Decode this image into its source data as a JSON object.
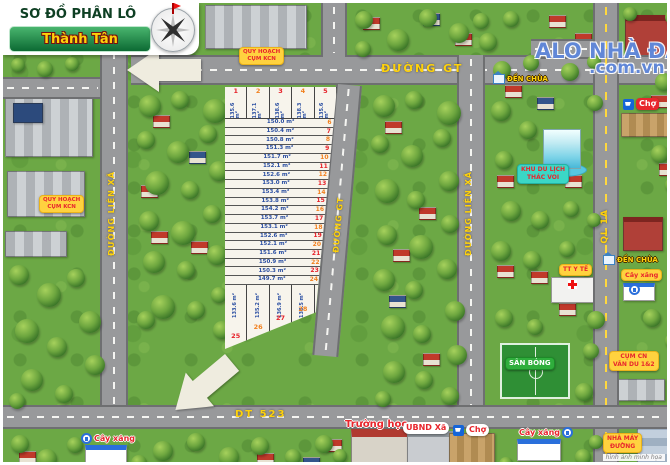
{
  "title": {
    "line1": "SƠ ĐỒ PHÂN LÔ",
    "line2": "Thành Tân"
  },
  "watermark": {
    "line1": "ALO NHÀ ĐẤT",
    "line2": ".com.vn"
  },
  "roads": {
    "gt_h": "ĐƯỜNG GT",
    "gt_v": "ĐƯỜNG GT",
    "lien_xa_left": "ĐƯỜNG LIÊN XÃ",
    "lien_xa_right": "ĐƯỜNG LIÊN XÃ",
    "ql": "QL 1A",
    "dt523": "DT 523"
  },
  "labels": {
    "quy_hoach_kcn_top": {
      "line1": "QUY HOẠCH",
      "line2": "CỤM KCN"
    },
    "quy_hoach_kcn_left": {
      "line1": "QUY HOẠCH",
      "line2": "CỤM KCN"
    },
    "den_chua_top": "ĐỀN CHÙA",
    "den_chua_right": "ĐỀN CHÙA",
    "cho_top": "Chợ",
    "cho_bottom": "Chợ",
    "khu_du_lich": {
      "line1": "KHU DU LỊCH",
      "line2": "THÁC VOI"
    },
    "tt_y_te": "TT Y TẾ",
    "cay_xang_right": "Cây xăng",
    "cay_xang_bottom_left": "Cây xăng",
    "cay_xang_bottom_mid": "Cây xăng",
    "san_bong": "SÂN BÓNG",
    "cum_cn": {
      "line1": "CỤM CN",
      "line2": "VÂN DU 1&2"
    },
    "truong_hoc": "Trường học",
    "ubnd_xa": "UBND Xã",
    "nha_may_duong": {
      "line1": "NHÀ MÁY",
      "line2": "ĐƯỜNG"
    },
    "caption": "hình ảnh minh họa"
  },
  "plots": {
    "unit": "m²",
    "top": [
      {
        "no": "1",
        "area": "135.6 m²"
      },
      {
        "no": "2",
        "area": "137.1 m²"
      },
      {
        "no": "3",
        "area": "138.6 m²"
      },
      {
        "no": "4",
        "area": "138.3 m²"
      },
      {
        "no": "5",
        "area": "135.6 m²"
      }
    ],
    "rows": [
      {
        "no": "6",
        "area": "150.0 m²"
      },
      {
        "no": "7",
        "area": "150.4 m²"
      },
      {
        "no": "8",
        "area": "150.8 m²"
      },
      {
        "no": "9",
        "area": "151.3 m²"
      },
      {
        "no": "10",
        "area": "151.7 m²"
      },
      {
        "no": "11",
        "area": "152.1 m²"
      },
      {
        "no": "12",
        "area": "152.6 m²"
      },
      {
        "no": "13",
        "area": "153.0 m²"
      },
      {
        "no": "14",
        "area": "153.4 m²"
      },
      {
        "no": "15",
        "area": "153.8 m²"
      },
      {
        "no": "16",
        "area": "154.2 m²"
      },
      {
        "no": "17",
        "area": "153.7 m²"
      },
      {
        "no": "18",
        "area": "153.1 m²"
      },
      {
        "no": "19",
        "area": "152.6 m²"
      },
      {
        "no": "20",
        "area": "152.1 m²"
      },
      {
        "no": "21",
        "area": "151.6 m²"
      },
      {
        "no": "22",
        "area": "150.9 m²"
      },
      {
        "no": "23",
        "area": "150.3 m²"
      },
      {
        "no": "24",
        "area": "149.7 m²"
      }
    ],
    "bottom": [
      {
        "no": "25",
        "area": "133.6 m²"
      },
      {
        "no": "26",
        "area": "135.2 m²"
      },
      {
        "no": "27",
        "area": "136.9 m²"
      },
      {
        "no": "28",
        "area": "138.5 m²"
      },
      {
        "no": "29",
        "area": "140.1 m²"
      }
    ]
  },
  "colors": {
    "grass": "#6ca845",
    "road": "#98999b",
    "plot_area_text": "#2b4fa2",
    "plot_no_red": "#e62129",
    "plot_no_orange": "#f1801f",
    "label_yellow": "#ffd23f",
    "label_red_text": "#e8262d",
    "road_label": "#ffd20a",
    "watermark_blue": "#3e6cce"
  }
}
